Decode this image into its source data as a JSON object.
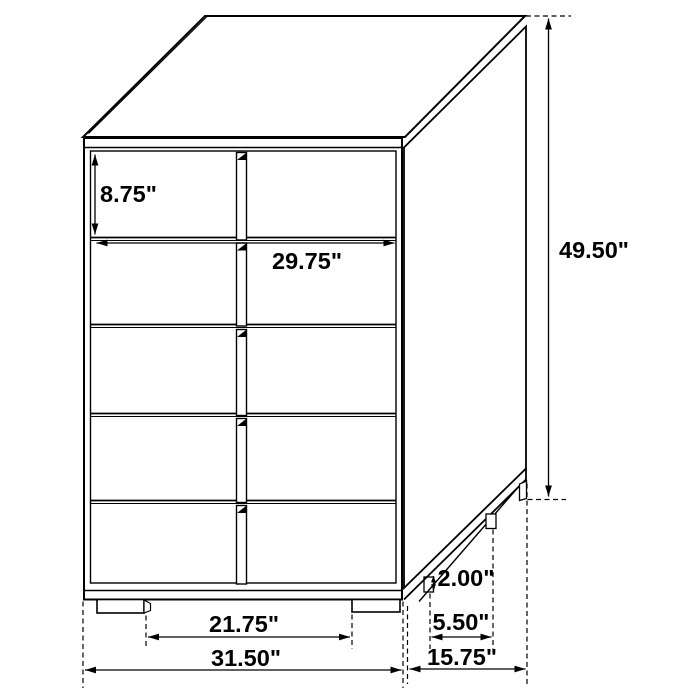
{
  "diagram": {
    "subject": "five-drawer-chest-dimension-drawing",
    "drawer_rows": 5,
    "background_color": "#ffffff",
    "line_color": "#000000",
    "dimensions": {
      "top_drawer_height": "8.75\"",
      "drawer_width": "29.75\"",
      "overall_height": "49.50\"",
      "foot_height": "2.00\"",
      "side_foot_spacing": "5.50\"",
      "front_foot_spacing": "21.75\"",
      "overall_width": "31.50\"",
      "overall_depth": "15.75\""
    }
  }
}
